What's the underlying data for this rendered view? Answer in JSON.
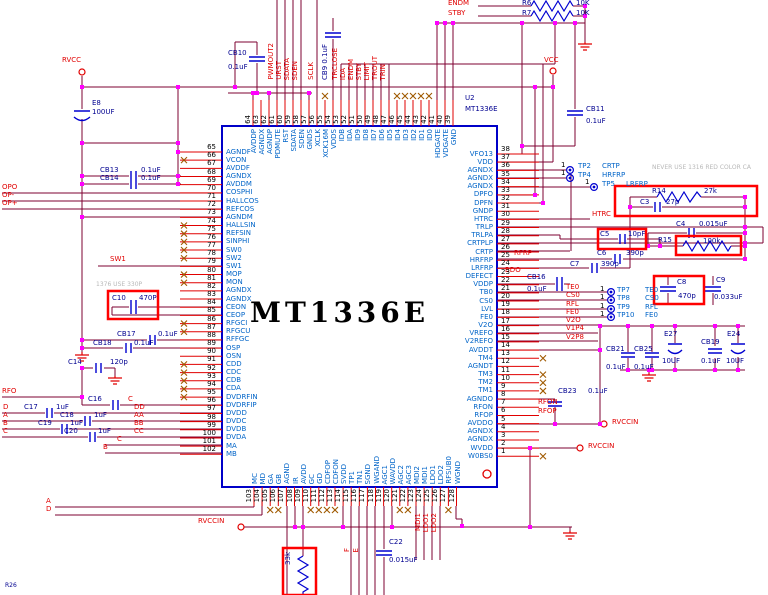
{
  "chip": {
    "designator": "U2",
    "part": "MT1336E",
    "center_label": "MT1336E"
  },
  "pins": {
    "left": [
      {
        "n": 65,
        "name": "AGNDF"
      },
      {
        "n": 66,
        "name": "VCON",
        "nc": true
      },
      {
        "n": 67,
        "name": "AVDDF"
      },
      {
        "n": 68,
        "name": "AGNDX"
      },
      {
        "n": 69,
        "name": "AVDDM"
      },
      {
        "n": 70,
        "name": "COSPHI"
      },
      {
        "n": 71,
        "name": "HALLCOS"
      },
      {
        "n": 72,
        "name": "REFCOS"
      },
      {
        "n": 73,
        "name": "AGNDM"
      },
      {
        "n": 74,
        "name": "HALLSIN",
        "nc": true
      },
      {
        "n": 75,
        "name": "REFSIN",
        "nc": true
      },
      {
        "n": 76,
        "name": "SINPHI",
        "nc": true
      },
      {
        "n": 77,
        "name": "SW0",
        "nc": true
      },
      {
        "n": 78,
        "name": "SW2",
        "nc": true
      },
      {
        "n": 79,
        "name": "SW1"
      },
      {
        "n": 80,
        "name": "MOP",
        "nc": true
      },
      {
        "n": 81,
        "name": "MON",
        "nc": true
      },
      {
        "n": 82,
        "name": "AGNDX"
      },
      {
        "n": 83,
        "name": "AGNDX"
      },
      {
        "n": 84,
        "name": "CEON"
      },
      {
        "n": 85,
        "name": "CEOP"
      },
      {
        "n": 86,
        "name": "RFGCI",
        "nc": true
      },
      {
        "n": 87,
        "name": "RFGCU",
        "nc": true
      },
      {
        "n": 88,
        "name": "RFFGC"
      },
      {
        "n": 89,
        "name": "OSP"
      },
      {
        "n": 90,
        "name": "OSN"
      },
      {
        "n": 91,
        "name": "CDD",
        "nc": true
      },
      {
        "n": 92,
        "name": "CDC",
        "nc": true
      },
      {
        "n": 93,
        "name": "CDB",
        "nc": true
      },
      {
        "n": 94,
        "name": "CDA",
        "nc": true
      },
      {
        "n": 95,
        "name": "DVDRFIN",
        "nc": true
      },
      {
        "n": 96,
        "name": "DVDRFIP"
      },
      {
        "n": 97,
        "name": "DVDD"
      },
      {
        "n": 98,
        "name": "DVDC"
      },
      {
        "n": 99,
        "name": "DVDB"
      },
      {
        "n": 100,
        "name": "DVDA"
      },
      {
        "n": 101,
        "name": "MA"
      },
      {
        "n": 102,
        "name": "MB"
      }
    ],
    "top": [
      {
        "n": 64,
        "name": "AVDDP"
      },
      {
        "n": 63,
        "name": "AGNDX"
      },
      {
        "n": 62,
        "name": "AGNDP"
      },
      {
        "n": 61,
        "name": "PDMUTE"
      },
      {
        "n": 60,
        "name": "RST"
      },
      {
        "n": 59,
        "name": "SDATA"
      },
      {
        "n": 58,
        "name": "SDEN"
      },
      {
        "n": 57,
        "name": "GNDS"
      },
      {
        "n": 56,
        "name": "XCLK"
      },
      {
        "n": 55,
        "name": "XCK16M",
        "nc": true
      },
      {
        "n": 54,
        "name": "VDDS"
      },
      {
        "n": 53,
        "name": "IDB"
      },
      {
        "n": 52,
        "name": "IDA"
      },
      {
        "n": 51,
        "name": "ID9"
      },
      {
        "n": 50,
        "name": "ID8"
      },
      {
        "n": 49,
        "name": "ID7"
      },
      {
        "n": 48,
        "name": "ID6"
      },
      {
        "n": 47,
        "name": "ID5"
      },
      {
        "n": 46,
        "name": "ID4",
        "nc": true
      },
      {
        "n": 45,
        "name": "ID3",
        "nc": true
      },
      {
        "n": 44,
        "name": "ID2",
        "nc": true
      },
      {
        "n": 43,
        "name": "ID1",
        "nc": true
      },
      {
        "n": 42,
        "name": "ID0",
        "nc": true
      },
      {
        "n": 41,
        "name": "HDGATE"
      },
      {
        "n": 40,
        "name": "VDGATE"
      },
      {
        "n": 39,
        "name": "GND"
      }
    ],
    "right": [
      {
        "n": 38,
        "name": "VFO13"
      },
      {
        "n": 37,
        "name": "VDD"
      },
      {
        "n": 36,
        "name": "AGNDX"
      },
      {
        "n": 35,
        "name": "AGNDX"
      },
      {
        "n": 34,
        "name": "AGNDX"
      },
      {
        "n": 33,
        "name": "DPFO"
      },
      {
        "n": 32,
        "name": "DPFN"
      },
      {
        "n": 31,
        "name": "GNDP"
      },
      {
        "n": 30,
        "name": "HTRC"
      },
      {
        "n": 29,
        "name": "TRLP"
      },
      {
        "n": 28,
        "name": "TRLPA"
      },
      {
        "n": 27,
        "name": "CRTPLP"
      },
      {
        "n": 26,
        "name": "CRTP"
      },
      {
        "n": 25,
        "name": "HRFRP"
      },
      {
        "n": 24,
        "name": "LRFRP"
      },
      {
        "n": 23,
        "name": "DEFECT"
      },
      {
        "n": 22,
        "name": "VDDP"
      },
      {
        "n": 21,
        "name": "TB0"
      },
      {
        "n": 20,
        "name": "CS0"
      },
      {
        "n": 19,
        "name": "LVL"
      },
      {
        "n": 18,
        "name": "FE0"
      },
      {
        "n": 17,
        "name": "V2O"
      },
      {
        "n": 16,
        "name": "VREFO"
      },
      {
        "n": 15,
        "name": "V2REFO"
      },
      {
        "n": 14,
        "name": "AVDDT"
      },
      {
        "n": 13,
        "name": "TM4",
        "nc": true
      },
      {
        "n": 12,
        "name": "AGNDT"
      },
      {
        "n": 11,
        "name": "TM3",
        "nc": true
      },
      {
        "n": 10,
        "name": "TM2",
        "nc": true
      },
      {
        "n": 9,
        "name": "TM1",
        "nc": true
      },
      {
        "n": 8,
        "name": "AGNDO"
      },
      {
        "n": 7,
        "name": "RFON"
      },
      {
        "n": 6,
        "name": "RFOP"
      },
      {
        "n": 5,
        "name": "AVDDO"
      },
      {
        "n": 4,
        "name": "AGNDX"
      },
      {
        "n": 3,
        "name": "AGNDX"
      },
      {
        "n": 2,
        "name": "WVDD"
      },
      {
        "n": 1,
        "name": "W0BS0",
        "nc": true
      }
    ],
    "bottom": [
      {
        "n": 103,
        "name": "MC"
      },
      {
        "n": 104,
        "name": "MD"
      },
      {
        "n": 105,
        "name": "GA",
        "nc": true
      },
      {
        "n": 106,
        "name": "GB",
        "nc": true
      },
      {
        "n": 107,
        "name": "AGND"
      },
      {
        "n": 108,
        "name": "IR"
      },
      {
        "n": 109,
        "name": "AVDD"
      },
      {
        "n": 110,
        "name": "GC",
        "nc": true
      },
      {
        "n": 111,
        "name": "GD",
        "nc": true
      },
      {
        "n": 112,
        "name": "CDFOP",
        "nc": true
      },
      {
        "n": 113,
        "name": "CDFON",
        "nc": true
      },
      {
        "n": 114,
        "name": "SVDD"
      },
      {
        "n": 115,
        "name": "TP1"
      },
      {
        "n": 116,
        "name": "TN1"
      },
      {
        "n": 117,
        "name": "SGND"
      },
      {
        "n": 118,
        "name": "WGAND"
      },
      {
        "n": 119,
        "name": "AGC1"
      },
      {
        "n": 120,
        "name": "WAVDD"
      },
      {
        "n": 121,
        "name": "AGC2",
        "nc": true
      },
      {
        "n": 122,
        "name": "AGC3",
        "nc": true
      },
      {
        "n": 123,
        "name": "MDI2"
      },
      {
        "n": 124,
        "name": "MDI1"
      },
      {
        "n": 125,
        "name": "LDO1"
      },
      {
        "n": 126,
        "name": "LDO2"
      },
      {
        "n": 127,
        "name": "RFSUB0",
        "nc": true
      },
      {
        "n": 128,
        "name": "WGND"
      }
    ]
  },
  "components": {
    "e8": {
      "ref": "E8",
      "val": "100UF"
    },
    "cb10": {
      "ref": "CB10",
      "val": "0.1uF"
    },
    "cb9": {
      "ref": "CB9",
      "val": "0.1uF"
    },
    "cb11": {
      "ref": "CB11",
      "val": "0.1uF"
    },
    "cb13": {
      "ref": "CB13",
      "val": "0.1uF"
    },
    "cb14": {
      "ref": "CB14",
      "val": "0.1uF"
    },
    "cb16": {
      "ref": "CB16",
      "val": "0.1uF"
    },
    "cb17": {
      "ref": "CB17",
      "val": "0.1uF"
    },
    "cb18": {
      "ref": "CB18",
      "val": "0.1uF"
    },
    "cb19": {
      "ref": "CB19",
      "val": "0.1uF"
    },
    "cb21": {
      "ref": "CB21",
      "val": "0.1uF"
    },
    "cb23": {
      "ref": "CB23",
      "val": "0.1uF"
    },
    "cb25": {
      "ref": "CB25",
      "val": "0.1uF"
    },
    "c3": {
      "ref": "C3",
      "val": "27p"
    },
    "c4": {
      "ref": "C4",
      "val": "0.015uF"
    },
    "c5": {
      "ref": "C5",
      "val": "10pF"
    },
    "c6": {
      "ref": "C6",
      "val": "390p"
    },
    "c7": {
      "ref": "C7",
      "val": "390p"
    },
    "c8": {
      "ref": "C8",
      "val": "470p"
    },
    "c9": {
      "ref": "C9",
      "val": "0.033uF"
    },
    "c10": {
      "ref": "C10",
      "val": "470P"
    },
    "c14": {
      "ref": "C14",
      "val": "120p"
    },
    "c16": {
      "ref": "C16",
      "val": ""
    },
    "c17": {
      "ref": "C17",
      "val": "1uF"
    },
    "c18": {
      "ref": "C18",
      "val": "1uF"
    },
    "c19": {
      "ref": "C19",
      "val": "1uF"
    },
    "c20": {
      "ref": "C20",
      "val": "1uF"
    },
    "c22": {
      "ref": "C22",
      "val": "0.015uF"
    },
    "e24": {
      "ref": "E24",
      "val": "10UF"
    },
    "e27": {
      "ref": "E27",
      "val": "10UF"
    },
    "r6": {
      "ref": "R6",
      "val": "10K"
    },
    "r7": {
      "ref": "R7",
      "val": "10K"
    },
    "r14": {
      "ref": "R14",
      "val": "27k"
    },
    "r15": {
      "ref": "R15",
      "val": "100k"
    },
    "r_bottom": {
      "ref": "",
      "val": "33k"
    }
  },
  "labels": {
    "rvcc": "RVCC",
    "vcc": "VCC",
    "rvccin": "RVCCIN",
    "opo": "OPO",
    "op_minus": "OP-",
    "op_plus": "OP+",
    "sw1": "SW1",
    "rfo": "RFO",
    "d": "D",
    "a": "A",
    "b": "B",
    "c": "C",
    "dd": "DD",
    "aa": "AA",
    "bb": "BB",
    "cc": "CC",
    "pwmout2": "PWMOUT2",
    "urst": "URST",
    "sdata": "SDATA",
    "sden": "SDEN",
    "sclk": "SCLK",
    "trclose": "TRCLOSE",
    "ida": "IDA",
    "endm": "ENDM",
    "stby": "STBY",
    "limit": "LIMIT",
    "trout": "TROUT",
    "trin": "TRIN",
    "htrc": "HTRC",
    "rfrp": "RFRP",
    "bdo": "BDO",
    "te0": "TE0",
    "cs0": "CS0",
    "rfl": "RFL",
    "fe0": "FE0",
    "v2o": "V2O",
    "v1p4": "V1P4",
    "v2p8": "V2P8",
    "rfon": "RFON",
    "rfop": "RFOP",
    "mdi1": "MDI1",
    "ldo1": "LDO1",
    "ldo2": "LDO2",
    "f": "F",
    "e": "E",
    "one": "1"
  },
  "testpoints": [
    {
      "id": "TP2",
      "net": "CRTP"
    },
    {
      "id": "TP4",
      "net": "HRFRP"
    },
    {
      "id": "TP5",
      "net": "LRFRP"
    },
    {
      "id": "TP7",
      "net": "TE0"
    },
    {
      "id": "TP8",
      "net": "CS0"
    },
    {
      "id": "TP9",
      "net": "RFL"
    },
    {
      "id": "TP10",
      "net": "FE0"
    }
  ],
  "notes": {
    "left_note": "1376 USE 330P",
    "right_note": "NEVER USE 1316 RED COLOR CA",
    "corner": "R26"
  },
  "colors": {
    "wire": "#7d0030",
    "pin_stub": "#e10000",
    "symbol_blue": "#0000d0",
    "pin_name": "#0064c8",
    "label_red": "#e10000",
    "component_text": "#000090",
    "junction": "#ff00ff",
    "highlight": "#ff0000",
    "no_connect": "#a05a00",
    "note_grey": "#b8b8b8"
  }
}
